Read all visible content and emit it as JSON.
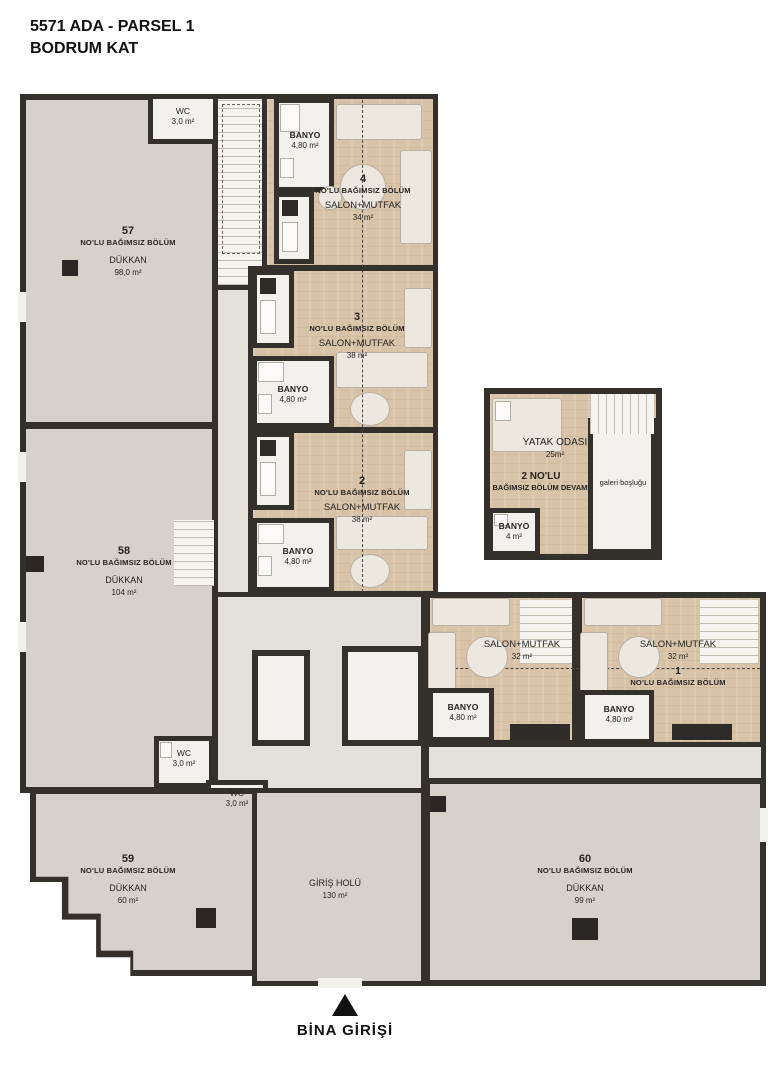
{
  "title": {
    "line1": "5571 ADA - PARSEL 1",
    "line2": "BODRUM KAT"
  },
  "shops": {
    "s57": {
      "number": "57",
      "unit_label": "NO'LU BAĞIMSIZ BÖLÜM",
      "use": "DÜKKAN",
      "area": "98,0 m²"
    },
    "s58": {
      "number": "58",
      "unit_label": "NO'LU BAĞIMSIZ BÖLÜM",
      "use": "DÜKKAN",
      "area": "104 m²"
    },
    "s59": {
      "number": "59",
      "unit_label": "NO'LU BAĞIMSIZ BÖLÜM",
      "use": "DÜKKAN",
      "area": "60 m²"
    },
    "s60": {
      "number": "60",
      "unit_label": "NO'LU BAĞIMSIZ BÖLÜM",
      "use": "DÜKKAN",
      "area": "99 m²"
    }
  },
  "hall": {
    "name": "GİRİŞ HOLÜ",
    "area": "130 m²"
  },
  "apartments": {
    "a4": {
      "number": "4",
      "unit_label": "NO'LU BAĞIMSIZ BÖLÜM",
      "room": "SALON+MUTFAK",
      "area": "34 m²",
      "bath_name": "BANYO",
      "bath_area": "4,80 m²"
    },
    "a3": {
      "number": "3",
      "unit_label": "NO'LU BAĞIMSIZ BÖLÜM",
      "room": "SALON+MUTFAK",
      "area": "38 m²",
      "bath_name": "BANYO",
      "bath_area": "4,80 m²"
    },
    "a2": {
      "number": "2",
      "unit_label": "NO'LU BAĞIMSIZ BÖLÜM",
      "room": "SALON+MUTFAK",
      "area": "38 m²",
      "bath_name": "BANYO",
      "bath_area": "4,80 m²"
    },
    "a2cont": {
      "label_line1": "2 NO'LU",
      "label_line2": "BAĞIMSIZ BÖLÜM DEVAMI",
      "bedroom_name": "YATAK ODASI",
      "bedroom_area": "25m²",
      "gallery": "galeri boşluğu",
      "bath_name": "BANYO",
      "bath_area": "4 m²"
    },
    "a1": {
      "number": "1",
      "unit_label": "NO'LU BAĞIMSIZ BÖLÜM",
      "room": "SALON+MUTFAK",
      "area": "32 m²",
      "bath_name": "BANYO",
      "bath_area": "4,80 m²"
    },
    "a_left": {
      "room": "SALON+MUTFAK",
      "area": "32 m²",
      "bath_name": "BANYO",
      "bath_area": "4,80 m²"
    }
  },
  "wcs": {
    "top": {
      "name": "WC",
      "area": "3,0 m²"
    },
    "mid1": {
      "name": "WC",
      "area": "3,0 m²"
    },
    "mid2": {
      "name": "WC",
      "area": "3,0 m²"
    }
  },
  "entrance": {
    "label": "BİNA GİRİŞİ"
  },
  "colors": {
    "wall": "#34302c",
    "shop_floor": "#d6d1ca",
    "wood_floor": "#d8c3a8",
    "white_floor": "#f3f1ee",
    "marker_black": "#111111"
  }
}
